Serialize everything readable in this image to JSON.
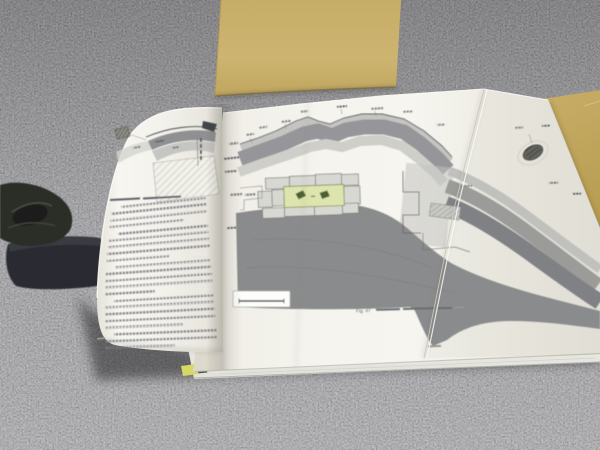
{
  "title": "Photograph: open archaeology report with fold-out stone-wall cross-section plate, lying on gray carpet",
  "colors": {
    "carpet": "#6b6b6b",
    "slipcase": "#c9b069",
    "slipcase_edge": "#8f7c44",
    "folder": "#c0a65f",
    "page": "#f3f2ec",
    "page_edge": "#e6e4da",
    "mass": "#8a8b8c",
    "stratum_light": "#c4c4c1",
    "stratum_dark": "#96969a",
    "stratum_pale": "#cfcfca",
    "band_right_light": "#c0c0bd",
    "band_right_dark": "#9b9b99",
    "band_right_deep": "#808184",
    "blocks": "#d8d8d3",
    "block_line": "#7a7a78",
    "highlight_rect": "#dde4ad",
    "highlight_glyph": "#4f5f33",
    "ink": "#55565a",
    "text_gray": "#84848c",
    "label_dark": "#4d4d55",
    "tab_yellow": "#d6d765",
    "dark_object": "#2b2e27",
    "shadow": "#1c1c1c"
  },
  "book": {
    "left_page": {
      "content": "dense Japanese body text, illegible at photo resolution",
      "text_line_count": 22,
      "paragraph_end_lines": [
        3,
        8,
        13,
        18,
        21
      ],
      "indent_lines": [
        0,
        4,
        9,
        14,
        19
      ],
      "figure": {
        "description": "small stratigraphic section diagram with hatched fill, gray arc bands and a small hatched box icon",
        "caption_legible": false
      }
    },
    "foldout": {
      "caption_fragment": "Fig. 47",
      "caption_note": "remainder of caption is small Japanese text, not legible",
      "figure": {
        "description": "large cross-section of an excavated stone wall: curved gray strata bands, outlined masonry blocks, yellow-green highlighted stone course with two dark-green stones, large gray fill mass, strata descending to the right across the fold",
        "has_scale_bar": true,
        "isolated_stone_detail": true,
        "tiny_margin_labels": "illegible"
      }
    },
    "page_stack": {
      "bookmark_tab": true,
      "ink_mark": true
    }
  },
  "environment": {
    "carpet": "mottled gray office carpet",
    "slipcase": "tan kraft-paper slipcase behind the book",
    "right_folder": "tan folder edge at right side",
    "dark_object": "dark book-weight object at left edge"
  }
}
